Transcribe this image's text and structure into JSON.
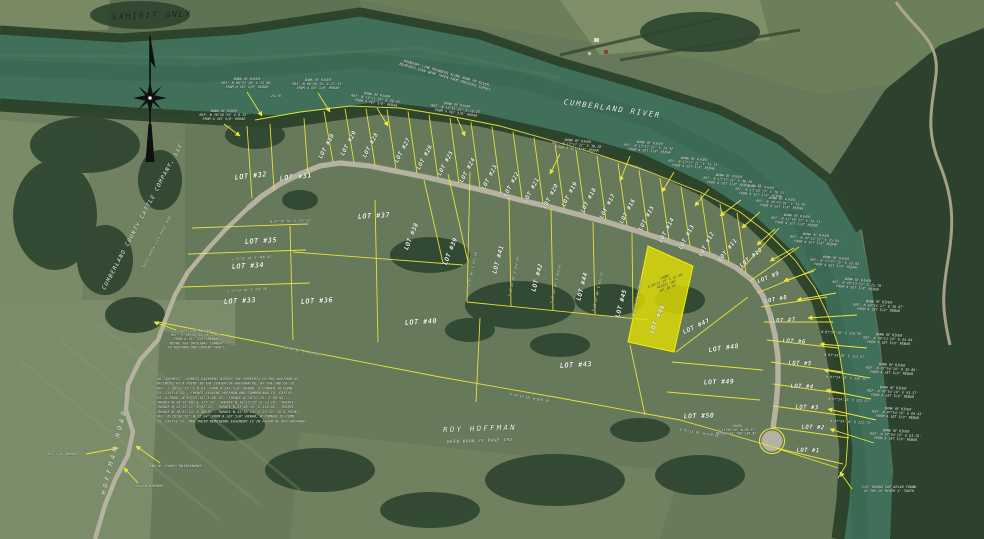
{
  "header": {
    "exhibit_stamp": {
      "text": "EXHIBIT ONLY",
      "x": 152,
      "y": 18,
      "rot": -2,
      "size": 8.5,
      "spacing": 1.5
    }
  },
  "map": {
    "colors": {
      "survey_line": "#ece73e",
      "highlight_fill": "#e6e200",
      "water": "#41705a",
      "text": "#f3f6ee"
    },
    "river_label": {
      "text": "CUMBERLAND RIVER",
      "x": 612,
      "y": 111,
      "rot": 8,
      "size": 7.5,
      "spacing": 1.6
    },
    "owner_labels": [
      {
        "text": "CUMBERLAND COUNTY CATTLE COMPANY, LLC.",
        "x": 145,
        "y": 215,
        "rot": -62,
        "size": 5.6,
        "spacing": 1.1
      },
      {
        "text": "DEED BOOK 134 PAGE 496",
        "x": 158,
        "y": 242,
        "rot": -62,
        "size": 3.4,
        "spacing": 0.6
      },
      {
        "text": "ROY HOFFMAN",
        "x": 480,
        "y": 431,
        "rot": -2,
        "size": 7.5,
        "spacing": 2.2
      },
      {
        "text": "DEED BOOK 21 PAGE 192",
        "x": 480,
        "y": 442,
        "rot": -2,
        "size": 4.2,
        "spacing": 0.6
      },
      {
        "text": "HOFFMAN ROAD",
        "x": 116,
        "y": 452,
        "rot": -76,
        "size": 6.5,
        "spacing": 3.5
      }
    ],
    "lots": [
      {
        "label": "LOT #1",
        "x": 808,
        "y": 452,
        "rot": 2,
        "size": 5.8
      },
      {
        "label": "LOT #2",
        "x": 813,
        "y": 429,
        "rot": 2,
        "size": 5.8
      },
      {
        "label": "LOT #3",
        "x": 807,
        "y": 409,
        "rot": 2,
        "size": 5.8
      },
      {
        "label": "LOT #4",
        "x": 802,
        "y": 388,
        "rot": 2,
        "size": 5.8
      },
      {
        "label": "LOT #5",
        "x": 800,
        "y": 365,
        "rot": 2,
        "size": 5.8
      },
      {
        "label": "LOT #6",
        "x": 794,
        "y": 343,
        "rot": 3,
        "size": 5.8
      },
      {
        "label": "LOT #7",
        "x": 784,
        "y": 322,
        "rot": -3,
        "size": 5.8
      },
      {
        "label": "LOT #8",
        "x": 776,
        "y": 301,
        "rot": -10,
        "size": 5.8
      },
      {
        "label": "LOT #9",
        "x": 769,
        "y": 279,
        "rot": -22,
        "size": 5.8
      },
      {
        "label": "LOT #10",
        "x": 752,
        "y": 259,
        "rot": -38,
        "size": 5.8
      },
      {
        "label": "LOT #11",
        "x": 729,
        "y": 251,
        "rot": -52,
        "size": 5.8
      },
      {
        "label": "LOT #12",
        "x": 708,
        "y": 245,
        "rot": -62,
        "size": 5.8
      },
      {
        "label": "LOT #13",
        "x": 688,
        "y": 238,
        "rot": -62,
        "size": 5.8
      },
      {
        "label": "LOT #14",
        "x": 668,
        "y": 231,
        "rot": -62,
        "size": 5.8
      },
      {
        "label": "LOT #15",
        "x": 648,
        "y": 219,
        "rot": -62,
        "size": 5.8
      },
      {
        "label": "LOT #16",
        "x": 629,
        "y": 212,
        "rot": -62,
        "size": 5.8
      },
      {
        "label": "LOT #17",
        "x": 609,
        "y": 207,
        "rot": -62,
        "size": 5.8
      },
      {
        "label": "LOT #18",
        "x": 590,
        "y": 201,
        "rot": -62,
        "size": 5.8
      },
      {
        "label": "LOT #19",
        "x": 571,
        "y": 195,
        "rot": -62,
        "size": 5.8
      },
      {
        "label": "LOT #20",
        "x": 552,
        "y": 197,
        "rot": -62,
        "size": 5.8
      },
      {
        "label": "LOT #21",
        "x": 533,
        "y": 191,
        "rot": -62,
        "size": 5.8
      },
      {
        "label": "LOT #22",
        "x": 513,
        "y": 185,
        "rot": -62,
        "size": 5.8
      },
      {
        "label": "LOT #23",
        "x": 491,
        "y": 178,
        "rot": -62,
        "size": 5.8
      },
      {
        "label": "LOT #24",
        "x": 469,
        "y": 171,
        "rot": -62,
        "size": 5.8
      },
      {
        "label": "LOT #25",
        "x": 447,
        "y": 164,
        "rot": -62,
        "size": 5.8
      },
      {
        "label": "LOT #26",
        "x": 426,
        "y": 158,
        "rot": -62,
        "size": 5.8
      },
      {
        "label": "LOT #27",
        "x": 404,
        "y": 151,
        "rot": -62,
        "size": 5.8
      },
      {
        "label": "LOT #28",
        "x": 372,
        "y": 146,
        "rot": -62,
        "size": 5.8
      },
      {
        "label": "LOT #29",
        "x": 350,
        "y": 144,
        "rot": -62,
        "size": 5.8
      },
      {
        "label": "LOT #30",
        "x": 328,
        "y": 147,
        "rot": -62,
        "size": 5.8
      },
      {
        "label": "LOT #31",
        "x": 296,
        "y": 179,
        "rot": -6,
        "size": 7
      },
      {
        "label": "LOT #32",
        "x": 251,
        "y": 178,
        "rot": -6,
        "size": 7
      },
      {
        "label": "LOT #33",
        "x": 240,
        "y": 303,
        "rot": -3,
        "size": 7
      },
      {
        "label": "LOT #34",
        "x": 248,
        "y": 268,
        "rot": -3,
        "size": 7
      },
      {
        "label": "LOT #35",
        "x": 261,
        "y": 243,
        "rot": -3,
        "size": 7
      },
      {
        "label": "LOT #36",
        "x": 317,
        "y": 303,
        "rot": -3,
        "size": 7
      },
      {
        "label": "LOT #37",
        "x": 374,
        "y": 218,
        "rot": -3,
        "size": 7
      },
      {
        "label": "LOT #38",
        "x": 413,
        "y": 237,
        "rot": -68,
        "size": 6.2
      },
      {
        "label": "LOT #39",
        "x": 452,
        "y": 252,
        "rot": -68,
        "size": 6.2
      },
      {
        "label": "LOT #40",
        "x": 421,
        "y": 324,
        "rot": -3,
        "size": 7
      },
      {
        "label": "LOT #41",
        "x": 500,
        "y": 260,
        "rot": -75,
        "size": 6.2
      },
      {
        "label": "LOT #42",
        "x": 539,
        "y": 278,
        "rot": -75,
        "size": 6.2
      },
      {
        "label": "LOT #43",
        "x": 576,
        "y": 367,
        "rot": -3,
        "size": 7
      },
      {
        "label": "LOT #44",
        "x": 584,
        "y": 287,
        "rot": -75,
        "size": 6.2
      },
      {
        "label": "LOT #45",
        "x": 623,
        "y": 304,
        "rot": -75,
        "size": 6.2
      },
      {
        "label": "LOT #46",
        "x": 659,
        "y": 320,
        "rot": -68,
        "size": 6.6,
        "highlight": true
      },
      {
        "label": "LOT #47",
        "x": 697,
        "y": 328,
        "rot": -25,
        "size": 6.2
      },
      {
        "label": "LOT #48",
        "x": 724,
        "y": 350,
        "rot": -8,
        "size": 6.6
      },
      {
        "label": "LOT #49",
        "x": 719,
        "y": 384,
        "rot": -2,
        "size": 6.6
      },
      {
        "label": "LOT #50",
        "x": 699,
        "y": 418,
        "rot": -2,
        "size": 6.6
      }
    ],
    "bank_notes": [
      {
        "x": 247,
        "y": 80,
        "rot": 0,
        "lines": [
          "BANK OF RIVER",
          "REF: N 06°37'10\" E 23.06'",
          "FROM A SET 5/8\" REBAR"
        ],
        "arrow": [
          247,
          92,
          262,
          116
        ]
      },
      {
        "x": 224,
        "y": 112,
        "rot": 0,
        "lines": [
          "BANK OF RIVER",
          "REF: N 30°56'34\" E 6.33'",
          "FROM A SET 5/8\" REBAR"
        ],
        "arrow": [
          224,
          124,
          240,
          136
        ]
      },
      {
        "x": 318,
        "y": 81,
        "rot": 0,
        "lines": [
          "BANK OF RIVER",
          "REF: N 06°58'43\" E 27.31'",
          "FROM A SET 5/8\" REBAR"
        ],
        "arrow": [
          318,
          93,
          330,
          112
        ]
      },
      {
        "x": 377,
        "y": 96,
        "rot": 8,
        "lines": [
          "BANK OF RIVER",
          "REF: N 13°11'58\" E 28.43'",
          "FROM A SET 5/8\" REBAR"
        ],
        "arrow": [
          377,
          108,
          388,
          126
        ]
      },
      {
        "x": 457,
        "y": 106,
        "rot": 8,
        "lines": [
          "BANK OF RIVER",
          "REF: N 13°51'21\" E 19.25'",
          "FROM A SET 5/8\" REBAR"
        ],
        "arrow": [
          457,
          118,
          465,
          136
        ]
      },
      {
        "x": 578,
        "y": 142,
        "rot": 5,
        "lines": [
          "BANK OF RIVER",
          "REF: N 13°57'21\" E 30.18'",
          "FROM A SET 5/8\" REBAR"
        ],
        "arrow": [
          560,
          154,
          550,
          174
        ]
      },
      {
        "x": 650,
        "y": 144,
        "rot": 5,
        "lines": [
          "BANK OF RIVER",
          "REF: N 13°57'21\" E 24.32'",
          "FROM A SET 5/8\" REBAR"
        ],
        "arrow": [
          630,
          156,
          620,
          181
        ]
      },
      {
        "x": 694,
        "y": 160,
        "rot": 5,
        "lines": [
          "BANK OF RIVER",
          "REF: N 13°57'21\" E 33.13'",
          "FROM A SET 5/8\" REBAR"
        ],
        "arrow": [
          674,
          172,
          662,
          192
        ]
      },
      {
        "x": 729,
        "y": 177,
        "rot": 5,
        "lines": [
          "BANK OF RIVER",
          "REF: N 13°57'21\" E 48.26'",
          "FROM A SET 5/8\" REBAR"
        ],
        "arrow": [
          709,
          189,
          695,
          206
        ]
      },
      {
        "x": 761,
        "y": 188,
        "rot": 5,
        "lines": [
          "BANK OF RIVER",
          "REF: N 13°58'33\" E 38.21'",
          "FROM A SET 5/8\" REBAR"
        ],
        "arrow": [
          741,
          200,
          720,
          216
        ]
      },
      {
        "x": 782,
        "y": 200,
        "rot": 5,
        "lines": [
          "BANK OF RIVER",
          "REF: N 36°43'01\" E 33.76'",
          "FROM A SET 5/8\" REBAR"
        ],
        "arrow": [
          760,
          212,
          742,
          228
        ]
      },
      {
        "x": 797,
        "y": 217,
        "rot": 5,
        "lines": [
          "BANK OF RIVER",
          "REF: N 15°58'33\" E 34.73'",
          "FROM A SET 5/8\" REBAR"
        ],
        "arrow": [
          775,
          229,
          757,
          245
        ]
      },
      {
        "x": 816,
        "y": 236,
        "rot": 5,
        "lines": [
          "BANK OF RIVER",
          "REF: N 44°54'51\" E 25.84'",
          "FROM A SET 5/8\" REBAR"
        ],
        "arrow": [
          794,
          248,
          770,
          261
        ]
      },
      {
        "x": 836,
        "y": 259,
        "rot": 5,
        "lines": [
          "BANK OF RIVER",
          "REF: N 57°47'35\" E 22.82'",
          "FROM A SET 5/8\" REBAR"
        ],
        "arrow": [
          814,
          271,
          784,
          281
        ]
      },
      {
        "x": 858,
        "y": 281,
        "rot": 5,
        "lines": [
          "BANK OF RIVER",
          "REF: N 48°13'53\" E 25.78'",
          "FROM A SET 5/8\" REBAR"
        ],
        "arrow": [
          836,
          293,
          797,
          300
        ]
      },
      {
        "x": 879,
        "y": 303,
        "rot": 3,
        "lines": [
          "BANK OF RIVER",
          "REF: N 64°51'11\" E 38.67'",
          "FROM A SET 5/8\" REBAR"
        ],
        "arrow": [
          857,
          315,
          808,
          318
        ]
      },
      {
        "x": 889,
        "y": 336,
        "rot": 3,
        "lines": [
          "BANK OF RIVER",
          "REF: N 76°13'19\" E 24.84'",
          "FROM A SET 5/8\" REBAR"
        ],
        "arrow": [
          867,
          348,
          820,
          344
        ]
      },
      {
        "x": 892,
        "y": 366,
        "rot": 3,
        "lines": [
          "BANK OF RIVER",
          "REF: N 87°54'18\" E 38.09'",
          "FROM A SET 5/8\" REBAR"
        ],
        "arrow": [
          870,
          378,
          824,
          370
        ]
      },
      {
        "x": 893,
        "y": 389,
        "rot": 3,
        "lines": [
          "BANK OF RIVER",
          "REF: N 87°54'18\" E 83.37'",
          "FROM A SET 5/8\" REBAR"
        ],
        "arrow": [
          871,
          399,
          826,
          390
        ]
      },
      {
        "x": 898,
        "y": 410,
        "rot": 3,
        "lines": [
          "BANK OF RIVER",
          "REF: N 87°54'18\" E 69.43'",
          "FROM A SET 5/8\" REBAR"
        ],
        "arrow": [
          876,
          420,
          828,
          409
        ]
      },
      {
        "x": 896,
        "y": 432,
        "rot": 3,
        "lines": [
          "BANK OF RIVER",
          "REF: N 87°54'18\" E 63.76'",
          "FROM A SET 5/8\" REBAR"
        ],
        "arrow": [
          874,
          443,
          830,
          429
        ]
      }
    ],
    "bearing_texts": [
      {
        "text": "S 74°52'30\" E 435.10'",
        "x": 300,
        "y": 352,
        "rot": 11
      },
      {
        "text": "N 74°52'30\" W 630.36'",
        "x": 530,
        "y": 399,
        "rot": 10
      },
      {
        "text": "N 74°52'30\" W 639.06'",
        "x": 700,
        "y": 434,
        "rot": 9
      },
      {
        "text": "S 15°07'30\" E 435.16'",
        "x": 473,
        "y": 271,
        "rot": -78
      },
      {
        "text": "S 15°07'30\" E 432.34'",
        "x": 515,
        "y": 276,
        "rot": -78
      },
      {
        "text": "S 15°07'30\" E 428.01'",
        "x": 557,
        "y": 283,
        "rot": -78
      },
      {
        "text": "S 15°07'30\" E 433.25'",
        "x": 599,
        "y": 291,
        "rot": -78
      },
      {
        "text": "S 15°07'30\" E 430.10'",
        "x": 638,
        "y": 298,
        "rot": -78
      },
      {
        "text": "N 87°54'18\" E 316.96'",
        "x": 842,
        "y": 334,
        "rot": 3
      },
      {
        "text": "N 87°54'18\" E 313.37'",
        "x": 845,
        "y": 357,
        "rot": 3
      },
      {
        "text": "N 87°54'18\" E 318.44'",
        "x": 847,
        "y": 379,
        "rot": 3
      },
      {
        "text": "N 87°54'18\" E 313.13'",
        "x": 849,
        "y": 401,
        "rot": 3
      },
      {
        "text": "N 87°54'18\" E 313.73'",
        "x": 851,
        "y": 423,
        "rot": 3
      },
      {
        "text": "S 74°52'30\" E 488.04'",
        "x": 252,
        "y": 259,
        "rot": -4
      },
      {
        "text": "S 74°52'30\" E 456.30'",
        "x": 248,
        "y": 291,
        "rot": -4
      },
      {
        "text": "N 07°58'36\" E 131.52'",
        "x": 291,
        "y": 222,
        "rot": -2
      },
      {
        "text": "24.76'",
        "x": 277,
        "y": 97,
        "rot": 0
      },
      {
        "text": "48.73'",
        "x": 757,
        "y": 187,
        "rot": 0
      }
    ],
    "chord_notes": [
      {
        "x": 737,
        "y": 427,
        "rot": 0,
        "dark": false,
        "lines": [
          "CHORD",
          "S 14°09'28\" W 88.33'",
          "RADIUS 50'  ARC 184.62'"
        ]
      },
      {
        "x": 665,
        "y": 278,
        "rot": -20,
        "dark": true,
        "lines": [
          "CHORD",
          "S 89°57'29\" E 61.90'",
          "RADIUS 380'",
          "ARC 68.04'"
        ]
      }
    ],
    "poi_notes": [
      {
        "x": 196,
        "y": 332,
        "rot": 0,
        "lines": [
          "SET 5/8\" REBAR",
          "REF: S 78°43'52\" E 7.87'",
          "FROM A SET 5/8\" REBAR",
          "BEING THE ORIGINAL CORNER",
          "TO HOFFMAN AND PARENT TRACT"
        ],
        "arrow": [
          176,
          330,
          154,
          322
        ]
      },
      {
        "x": 62,
        "y": 455,
        "rot": 0,
        "lines": [
          "SET 5/8\" REBAR"
        ],
        "arrow": [
          86,
          454,
          118,
          448
        ]
      },
      {
        "x": 176,
        "y": 467,
        "rot": 0,
        "lines": [
          "END OF COUNTY MAINTENANCE"
        ],
        "arrow": [
          160,
          463,
          136,
          446
        ]
      },
      {
        "x": 150,
        "y": 487,
        "rot": 0,
        "lines": [
          "FLUSH HYDRANT"
        ],
        "arrow": [
          138,
          483,
          124,
          468
        ]
      },
      {
        "x": 889,
        "y": 488,
        "rot": 0,
        "lines": [
          "5/8\" REBAR CAP #2148 FOUND",
          "AT THE OF RIVER 4' SOUTH"
        ],
        "arrow": [
          852,
          489,
          840,
          472
        ]
      },
      {
        "x": 446,
        "y": 74,
        "rot": 16,
        "lines": [
          "BOUNDARY LINE MEANDERS ALONG BANK OF RIVER",
          "BEARINGS USED WERE TAKEN FROM PREVIOUS SURVEY"
        ]
      }
    ],
    "easement_note": {
      "x": 157,
      "y": 380,
      "line_height": 4.7,
      "size": 3.5,
      "lines": [
        "40' INGRESS - EGRESS EASEMENT ACROSS THE PROPERTY OF ROY HOFFMAN AS",
        "RECORDED AT A POINT IN THE CENTER OF HOFFMAN RD. AT THE END OF CO.",
        "REF: S 09°53'37\" E 6.81' FROM A SET 5/8\" REBAR, A CORNER TO CUMB.",
        "CO. CATTLE CO.; THENCE LEAVING HOFFMAN AND CUMBERLAND CO. CATTLE",
        "CO. A ROAD; N 13°03'14\" E 98.70'; THENCE N 70°57'21\" E 88.94';",
        "THENCE N 39°14'09\" E 123.52'; THENCE N 10°15'25\" E 73.18'; THENCE",
        "THENCE N 15°12'47\" E 63.25'; THENCE N 23°46'35\" E 118.02'; THENCE",
        "THENCE N 18°37'24\" E 46.95'; THENCE N 11°30'14\" E 27.72' TO A POINT",
        "REF: N 79°04'51\" W 12.04' FROM A SET 5/8\" REBAR, A CORNER TO CUMB.",
        "CO. CATTLE CO. AND THEIR REMAINING EASEMENT IS IN FAVOR OF ROY HOFFMAN"
      ]
    }
  }
}
